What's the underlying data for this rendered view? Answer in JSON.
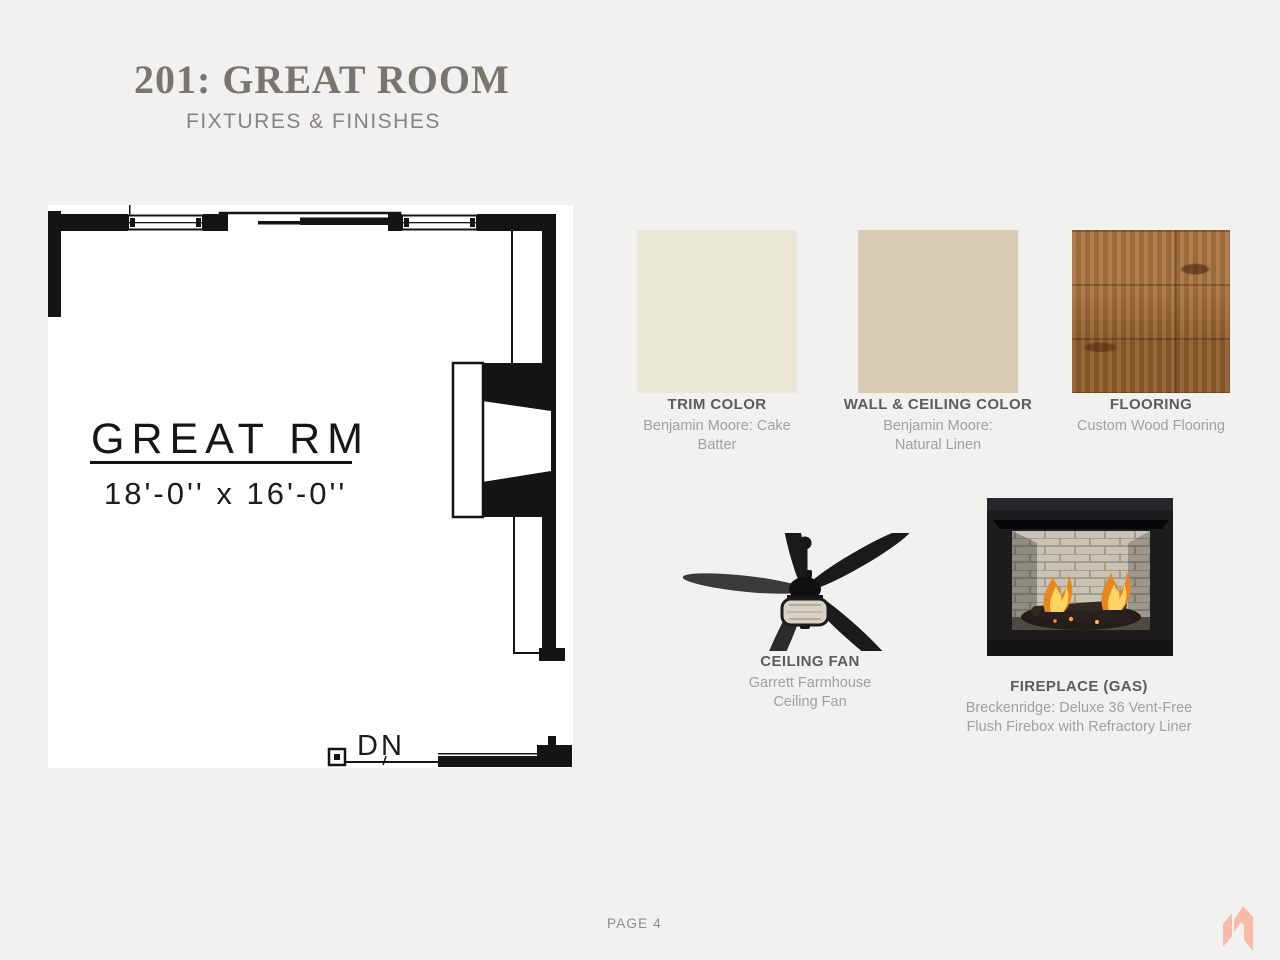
{
  "slide": {
    "title": "201: GREAT ROOM",
    "subtitle": "FIXTURES & FINISHES",
    "page_label": "PAGE 4"
  },
  "floor_plan": {
    "room_name": "GREAT RM",
    "room_dimensions": "18'-0'' x 16'-0''",
    "stair_label": "DN"
  },
  "finishes": [
    {
      "label": "TRIM COLOR",
      "description": "Benjamin Moore: Cake Batter",
      "swatch_color": "#ece8d8"
    },
    {
      "label": "WALL & CEILING COLOR",
      "description": "Benjamin Moore: Natural Linen",
      "swatch_color": "#d8cdb4"
    },
    {
      "label": "FLOORING",
      "description": "Custom Wood Flooring",
      "swatch_color": "#9a6430"
    }
  ],
  "fixtures": [
    {
      "label": "CEILING FAN",
      "description": "Garrett Farmhouse Ceiling Fan"
    },
    {
      "label": "FIREPLACE (GAS)",
      "description": "Breckenridge: Deluxe 36 Vent-Free Flush Firebox with Refractory Liner"
    }
  ],
  "theme": {
    "background": "#f1f1f0",
    "title_color": "#7a756f",
    "label_color": "#5f5c58",
    "description_color": "#a3a09c",
    "plan_ink": "#141414",
    "logo_color": "#f7bba9"
  }
}
